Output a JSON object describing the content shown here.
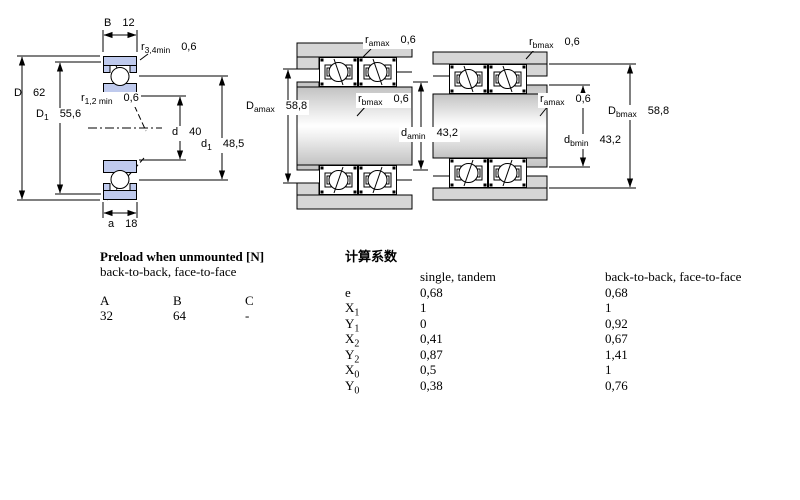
{
  "figure_left": {
    "dims": {
      "B": {
        "base": "B",
        "sub": "",
        "value": "12"
      },
      "r34": {
        "base": "r",
        "sub": "3,4min",
        "value": "0,6"
      },
      "D": {
        "base": "D",
        "sub": "",
        "value": "62"
      },
      "D1": {
        "base": "D",
        "sub": "1",
        "value": "55,6"
      },
      "r12": {
        "base": "r",
        "sub": "1,2 min",
        "value": "0,6"
      },
      "d": {
        "base": "d",
        "sub": "",
        "value": "40"
      },
      "d1": {
        "base": "d",
        "sub": "1",
        "value": "48,5"
      },
      "a": {
        "base": "a",
        "sub": "",
        "value": "18"
      }
    }
  },
  "figure_middle": {
    "dims": {
      "ramax": {
        "base": "r",
        "sub": "amax",
        "value": "0,6"
      },
      "Damax": {
        "base": "D",
        "sub": "amax",
        "value": "58,8"
      },
      "rbmax": {
        "base": "r",
        "sub": "bmax",
        "value": "0,6"
      },
      "damin": {
        "base": "d",
        "sub": "amin",
        "value": "43,2"
      }
    }
  },
  "figure_right": {
    "dims": {
      "rbmax": {
        "base": "r",
        "sub": "bmax",
        "value": "0,6"
      },
      "ramax": {
        "base": "r",
        "sub": "amax",
        "value": "0,6"
      },
      "Dbmax": {
        "base": "D",
        "sub": "bmax",
        "value": "58,8"
      },
      "dbmin": {
        "base": "d",
        "sub": "bmin",
        "value": "43,2"
      }
    }
  },
  "preload_table": {
    "title": "Preload when unmounted [N]",
    "subtitle": "back-to-back, face-to-face",
    "columns": [
      "A",
      "B",
      "C"
    ],
    "values": [
      "32",
      "64",
      "-"
    ]
  },
  "factors_table": {
    "title": "计算系数",
    "col1_header": "single, tandem",
    "col2_header": "back-to-back, face-to-face",
    "rows": [
      {
        "base": "e",
        "sub": "",
        "v1": "0,68",
        "v2": "0,68"
      },
      {
        "base": "X",
        "sub": "1",
        "v1": "1",
        "v2": "1"
      },
      {
        "base": "Y",
        "sub": "1",
        "v1": "0",
        "v2": "0,92"
      },
      {
        "base": "X",
        "sub": "2",
        "v1": "0,41",
        "v2": "0,67"
      },
      {
        "base": "Y",
        "sub": "2",
        "v1": "0,87",
        "v2": "1,41"
      },
      {
        "base": "X",
        "sub": "0",
        "v1": "0,5",
        "v2": "1"
      },
      {
        "base": "Y",
        "sub": "0",
        "v1": "0,38",
        "v2": "0,76"
      }
    ]
  },
  "colors": {
    "ring_fill": "#bfcaed",
    "housing_fill": "#d6d6d6",
    "line": "#000000",
    "background": "#ffffff"
  }
}
